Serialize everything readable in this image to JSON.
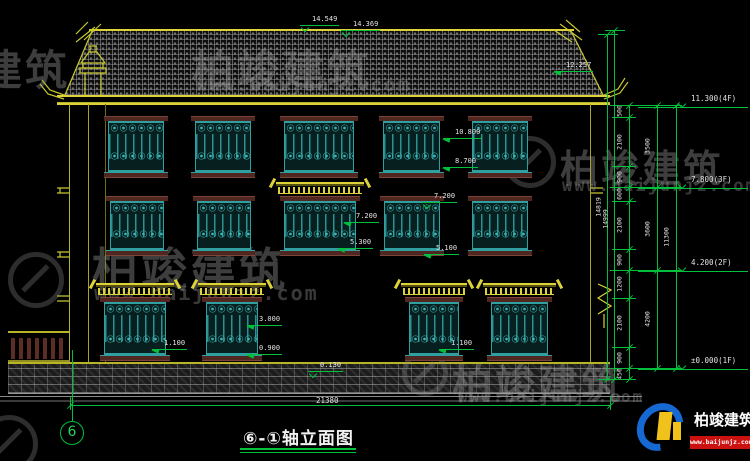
{
  "colors": {
    "line_yellow": "#b8b428",
    "bright_yellow": "#ddd23a",
    "dim_green": "#00c03c",
    "text_white": "#e4e4e4",
    "window_teal": "#2f9f9f",
    "frame_maroon": "#502620",
    "brand_blue": "#1668d2",
    "brand_yellow": "#f2c21c",
    "brand_red": "#cc1111"
  },
  "drawing": {
    "title": "⑥-①轴立面图",
    "axis_bubble": "6",
    "windows": {
      "rows": [
        {
          "name": "floor-3",
          "y": 116,
          "h": 62,
          "wins": [
            {
              "x": 108,
              "w": 56
            },
            {
              "x": 195,
              "w": 56
            },
            {
              "x": 284,
              "w": 70
            },
            {
              "x": 383,
              "w": 57
            },
            {
              "x": 472,
              "w": 56
            }
          ]
        },
        {
          "name": "floor-2",
          "y": 196,
          "h": 60,
          "wins": [
            {
              "x": 110,
              "w": 54
            },
            {
              "x": 197,
              "w": 54
            },
            {
              "x": 284,
              "w": 72,
              "canopy": true
            },
            {
              "x": 384,
              "w": 56
            },
            {
              "x": 472,
              "w": 56
            }
          ]
        },
        {
          "name": "floor-1",
          "y": 297,
          "h": 64,
          "wins": [
            {
              "x": 104,
              "w": 62,
              "canopy": true
            },
            {
              "x": 206,
              "w": 52,
              "canopy": true
            },
            {
              "x": 409,
              "w": 50,
              "canopy": true
            },
            {
              "x": 491,
              "w": 57,
              "canopy": true
            }
          ]
        }
      ]
    },
    "annotations": [
      {
        "t": "14.549",
        "x": 312,
        "y": 15,
        "m": "tri"
      },
      {
        "t": "14.369",
        "x": 353,
        "y": 20,
        "m": "tri"
      },
      {
        "t": "12.257",
        "x": 566,
        "y": 61,
        "m": "arrow"
      },
      {
        "t": "10.800",
        "x": 455,
        "y": 128,
        "m": "arrow"
      },
      {
        "t": "8.700",
        "x": 455,
        "y": 157,
        "m": "arrow"
      },
      {
        "t": "7.200",
        "x": 356,
        "y": 212,
        "m": "arrow"
      },
      {
        "t": "5.300",
        "x": 350,
        "y": 238,
        "m": "arrow"
      },
      {
        "t": "7.200",
        "x": 434,
        "y": 192,
        "m": "tri"
      },
      {
        "t": "5.100",
        "x": 436,
        "y": 244,
        "m": "arrow"
      },
      {
        "t": "3.000",
        "x": 259,
        "y": 315,
        "m": "arrow"
      },
      {
        "t": "0.900",
        "x": 259,
        "y": 344,
        "m": "arrow"
      },
      {
        "t": "1.100",
        "x": 164,
        "y": 339,
        "m": "arrow"
      },
      {
        "t": "1.100",
        "x": 451,
        "y": 339,
        "m": "arrow"
      },
      {
        "t": "0.130",
        "x": 320,
        "y": 361,
        "m": "tri"
      }
    ],
    "floor_markers": [
      {
        "t": "11.300(4F)",
        "y": 107
      },
      {
        "t": "7.800(3F)",
        "y": 188
      },
      {
        "t": "4.200(2F)",
        "y": 271
      },
      {
        "t": "±0.000(1F)",
        "y": 369
      }
    ],
    "dim_cols": [
      {
        "x": 629,
        "segs": [
          [
            105,
            "500"
          ],
          [
            117,
            "2100"
          ],
          [
            166,
            "900"
          ],
          [
            187,
            "600"
          ],
          [
            201,
            "2100"
          ],
          [
            249,
            "900"
          ],
          [
            270,
            "1200"
          ],
          [
            298,
            "2100"
          ],
          [
            347,
            "900"
          ],
          [
            368,
            "450"
          ],
          [
            379,
            null
          ]
        ]
      },
      {
        "x": 657,
        "segs": [
          [
            105,
            "3500"
          ],
          [
            187,
            "3600"
          ],
          [
            270,
            "4200"
          ],
          [
            368,
            null
          ]
        ]
      },
      {
        "x": 676,
        "segs": [
          [
            105,
            "11300"
          ],
          [
            368,
            null
          ]
        ]
      }
    ],
    "overall_dims": [
      {
        "x": 607,
        "y1": 34,
        "y2": 379,
        "t": "14819"
      },
      {
        "x": 614,
        "y1": 30,
        "y2": 379,
        "t": "14999"
      }
    ],
    "bottom_dim": {
      "t": "21380",
      "y": 405,
      "x1": 70,
      "x2": 610,
      "tx": 316,
      "ty": 396
    }
  },
  "watermark": {
    "name": "柏竣建筑",
    "url": "www.baijunjz.com"
  },
  "brand": {
    "name": "柏竣建筑",
    "url": "www.baijunjz.com"
  }
}
